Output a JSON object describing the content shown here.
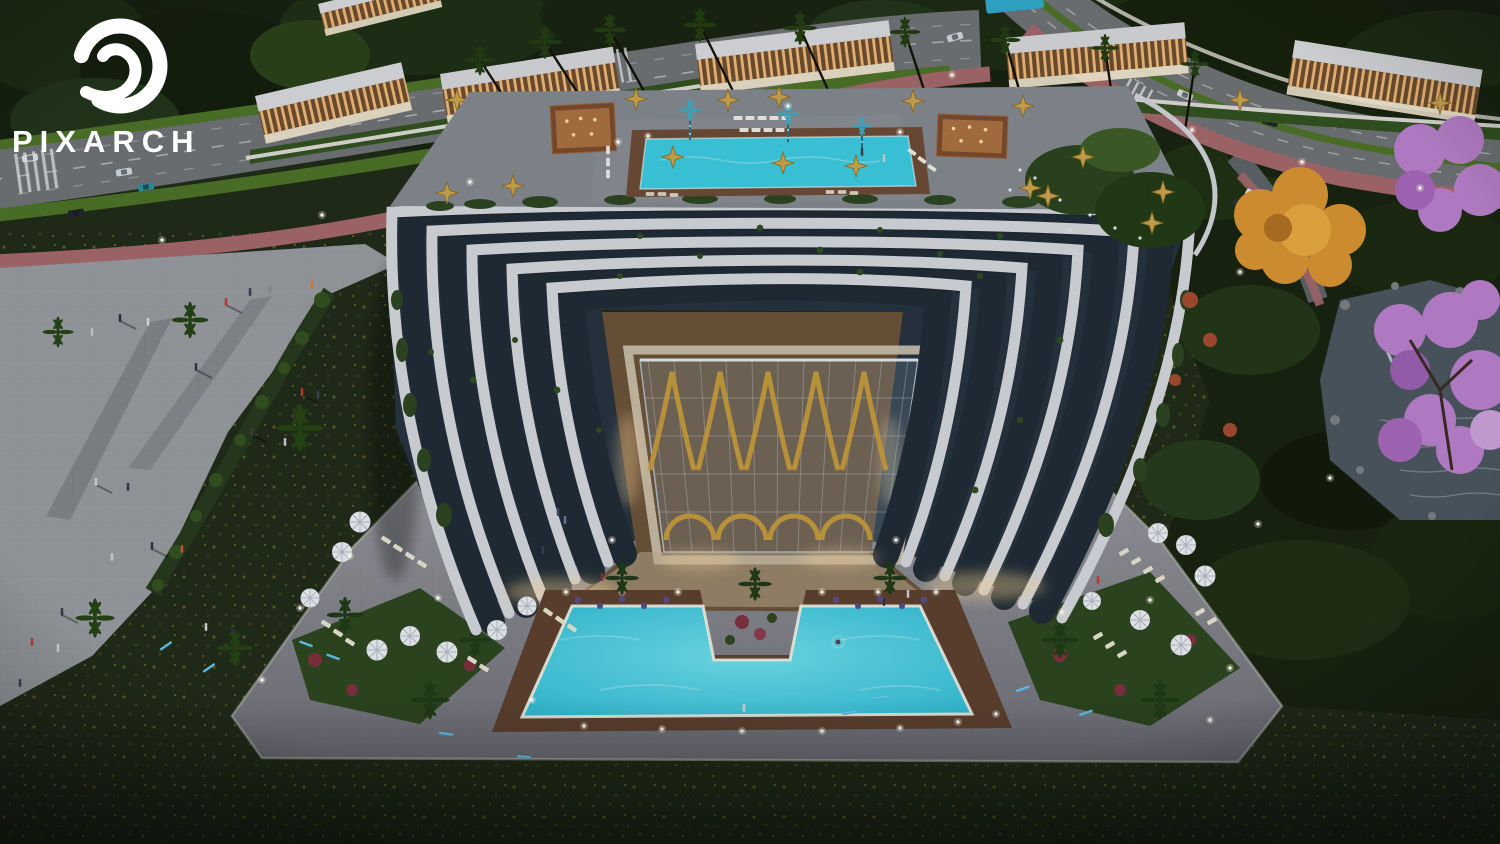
{
  "watermark": {
    "brand": "PIXARCH",
    "logo_icon": "wave-swirl-logo"
  },
  "scene": {
    "type": "aerial-3d-architectural-rendering",
    "time_of_day": "dusk",
    "subject": "Curved U-shaped residential resort building with rooftop pool, golden glass atrium courtyard and M-shaped ground pool",
    "surroundings": [
      "villa-row",
      "boulevard",
      "pedestrian-plaza",
      "flower-lawn",
      "pond-garden"
    ]
  },
  "palette": {
    "lawn_dark": "#202a16",
    "plaza_paving": "#97999d",
    "road_asphalt": "#6e7173",
    "pink_path": "#a4666a",
    "grass_verge": "#4c7026",
    "hedge_green": "#26381a",
    "building_band": "#d3d5d9",
    "glass_facade": "#1f2a33",
    "rooftop_deck": "#83868d",
    "courtyard_paving": "#6b5137",
    "atrium_gold": "#c79a3a",
    "pool_water": "#3cc9de",
    "pool_deck_brown": "#5d3f2c",
    "pond_water": "#4a545c",
    "autumn_tree": "#d8922f",
    "jacaranda": "#b87fc9",
    "umbrella_gold": "#c9a24b",
    "umbrella_white": "#e9ebee",
    "accent_light_blue": "#49b6e8"
  }
}
